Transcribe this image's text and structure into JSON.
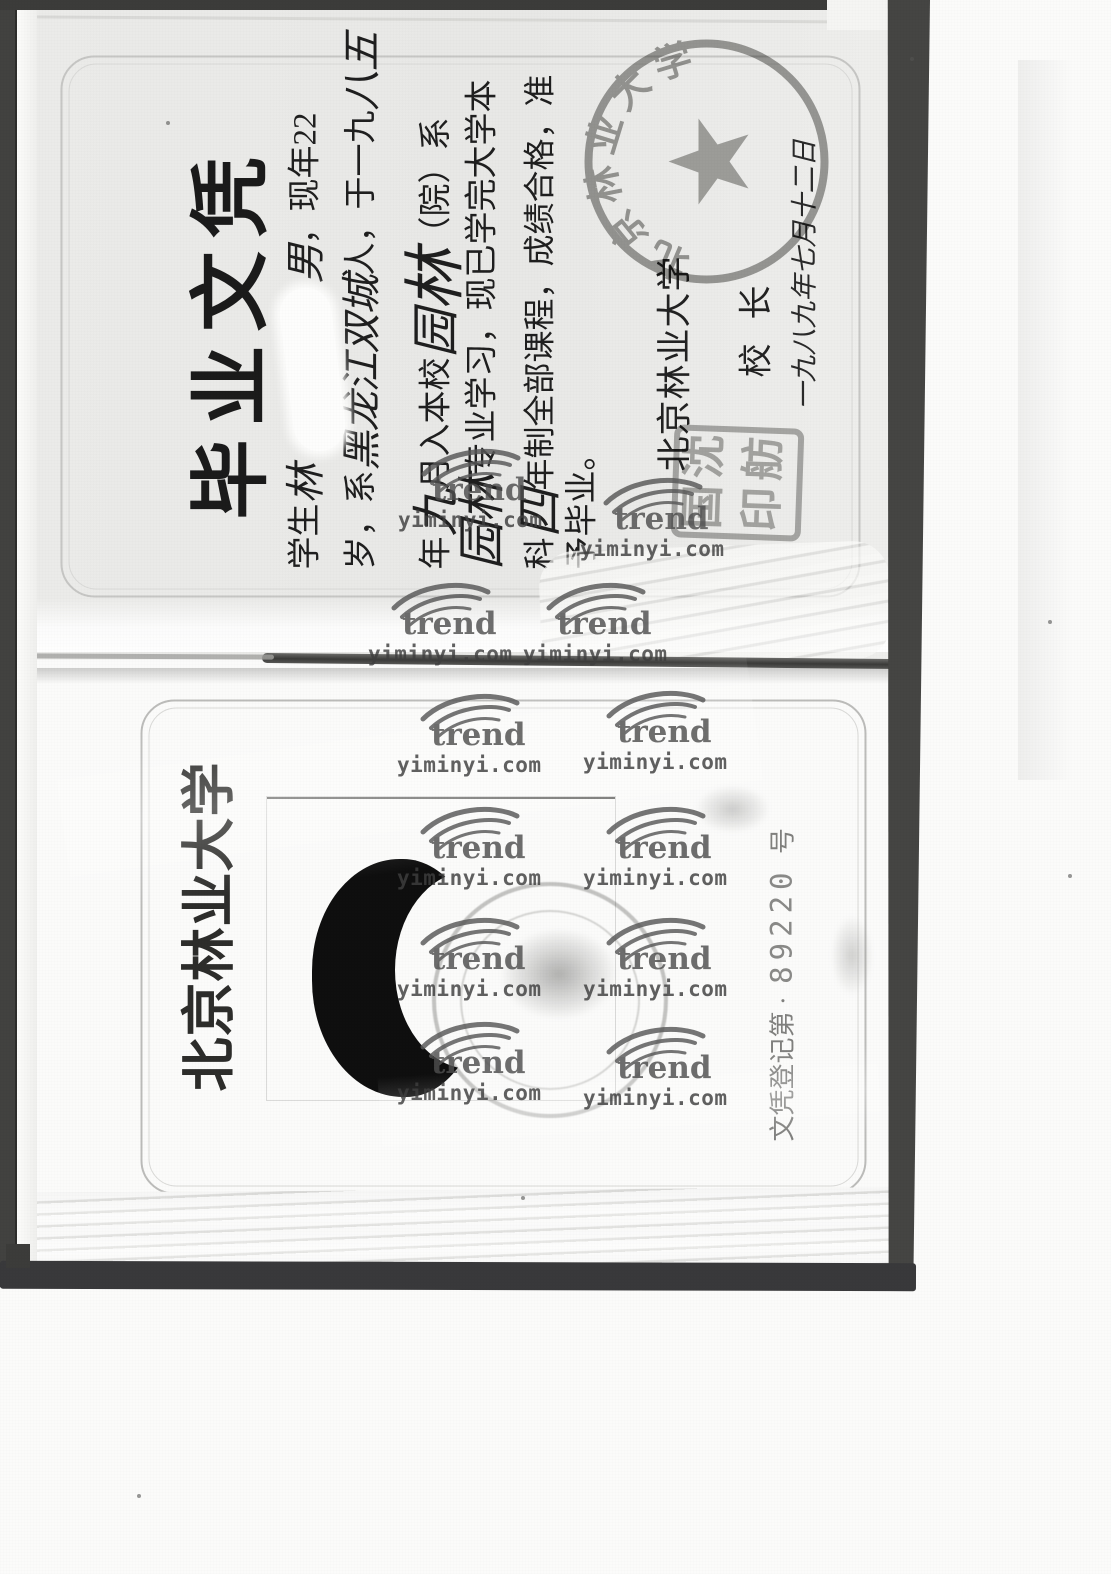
{
  "diploma": {
    "title": "毕业文凭",
    "lines": [
      {
        "parts": [
          {
            "t": "学生",
            "s": "p"
          },
          {
            "t": "林",
            "s": "hw"
          },
          {
            "t": "",
            "s": "gap"
          },
          {
            "t": "，",
            "s": "p"
          },
          {
            "t": "男",
            "s": "hw"
          },
          {
            "t": "，现年22",
            "s": "p"
          }
        ]
      },
      {
        "parts": [
          {
            "t": "岁，系",
            "s": "p"
          },
          {
            "t": "黑龙江双城",
            "s": "hw"
          },
          {
            "t": "人，于一九",
            "s": "p"
          },
          {
            "t": "八五",
            "s": "hw"
          }
        ]
      },
      {
        "parts": [
          {
            "t": "年",
            "s": "p"
          },
          {
            "t": "九",
            "s": "hwl"
          },
          {
            "t": "月入本校",
            "s": "p"
          },
          {
            "t": "园",
            "s": "hwl"
          },
          {
            "t": "林",
            "s": "hwx"
          },
          {
            "t": "（院）系",
            "s": "p"
          }
        ]
      },
      {
        "parts": [
          {
            "t": "园林",
            "s": "hwl"
          },
          {
            "t": "专业学习，现已学完大学本",
            "s": "p"
          }
        ]
      },
      {
        "parts": [
          {
            "t": "科",
            "s": "p"
          },
          {
            "t": "四",
            "s": "hwl"
          },
          {
            "t": "年制全部课程，成绩合格，准",
            "s": "p"
          }
        ]
      },
      {
        "parts": [
          {
            "t": "予毕业。",
            "s": "p"
          }
        ]
      }
    ],
    "issuer": "北京林业大学",
    "president_label": "校长",
    "date": "一九八九年七月十二日",
    "round_seal_text": "北京林业大学",
    "name_seal_chars": [
      "国",
      "沈",
      "印",
      "舫"
    ]
  },
  "back": {
    "university": "北京林业大学",
    "reg_label": "文凭登记第",
    "reg_sep": "·",
    "reg_number": "89220",
    "reg_suffix": "号"
  },
  "watermark": {
    "brand": "trend",
    "url": "yiminyi.com",
    "positions": [
      [
        398,
        508
      ],
      [
        580,
        537
      ],
      [
        368,
        642
      ],
      [
        523,
        642
      ],
      [
        397,
        753
      ],
      [
        583,
        750
      ],
      [
        397,
        866
      ],
      [
        583,
        866
      ],
      [
        397,
        977
      ],
      [
        583,
        977
      ],
      [
        397,
        1081
      ],
      [
        583,
        1086
      ]
    ]
  }
}
